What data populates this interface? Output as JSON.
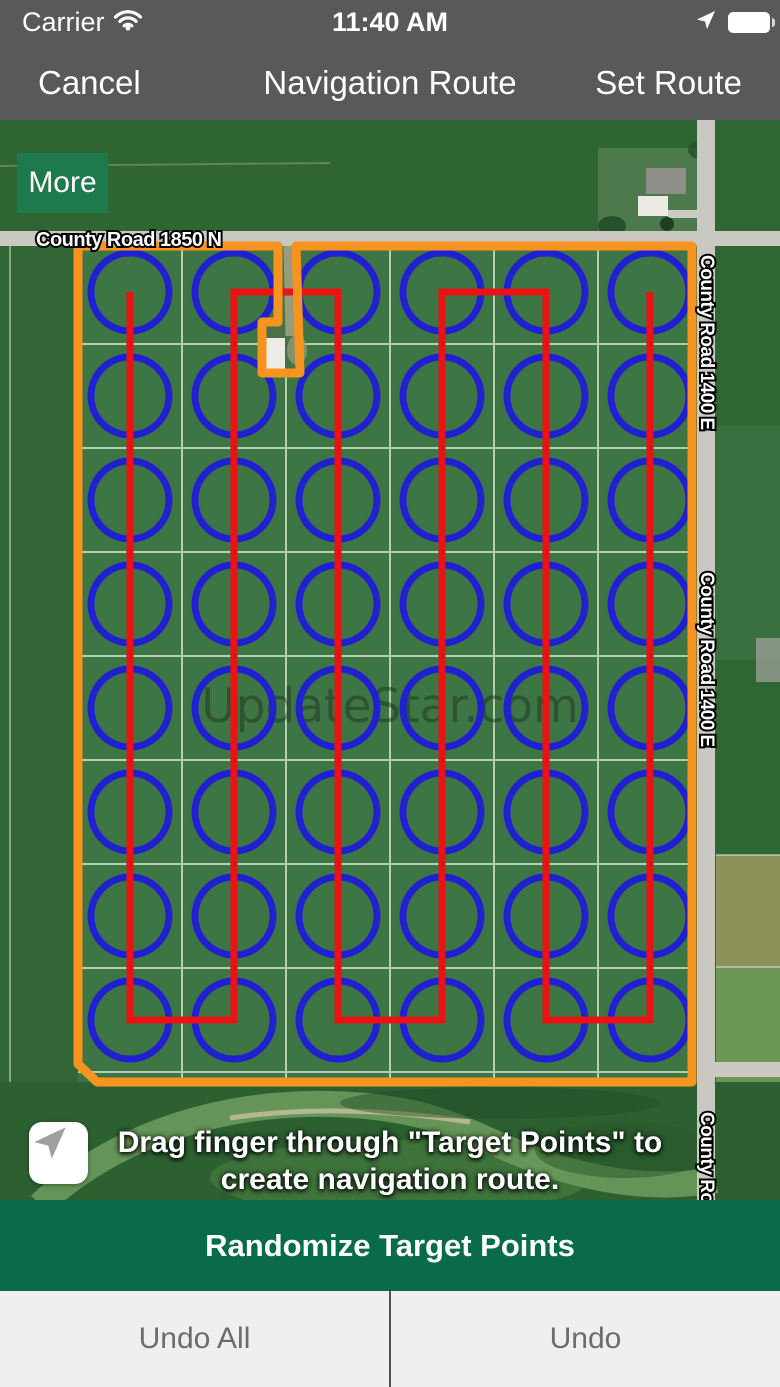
{
  "status_bar": {
    "carrier": "Carrier",
    "time": "11:40 AM"
  },
  "nav_bar": {
    "cancel": "Cancel",
    "title": "Navigation Route",
    "set_route": "Set Route"
  },
  "map": {
    "more_button": "More",
    "watermark": "UpdateStar.com",
    "road_labels": {
      "top": "County Road 1850 N",
      "right": "County Road 1400 E"
    },
    "instruction_line1": "Drag finger through \"Target Points\" to",
    "instruction_line2": "create navigation route.",
    "colors": {
      "boundary": "#f6941f",
      "route": "#ea1212",
      "target_point": "#2020d0"
    },
    "grid": {
      "cols": 6,
      "rows": 8,
      "col_start": 130,
      "row_start": 292,
      "col_spacing": 104,
      "row_spacing": 104,
      "circle_radius": 39,
      "route_top_y": 292,
      "route_bottom_y": 1020
    }
  },
  "actions": {
    "randomize": "Randomize Target Points",
    "undo_all": "Undo All",
    "undo": "Undo"
  }
}
